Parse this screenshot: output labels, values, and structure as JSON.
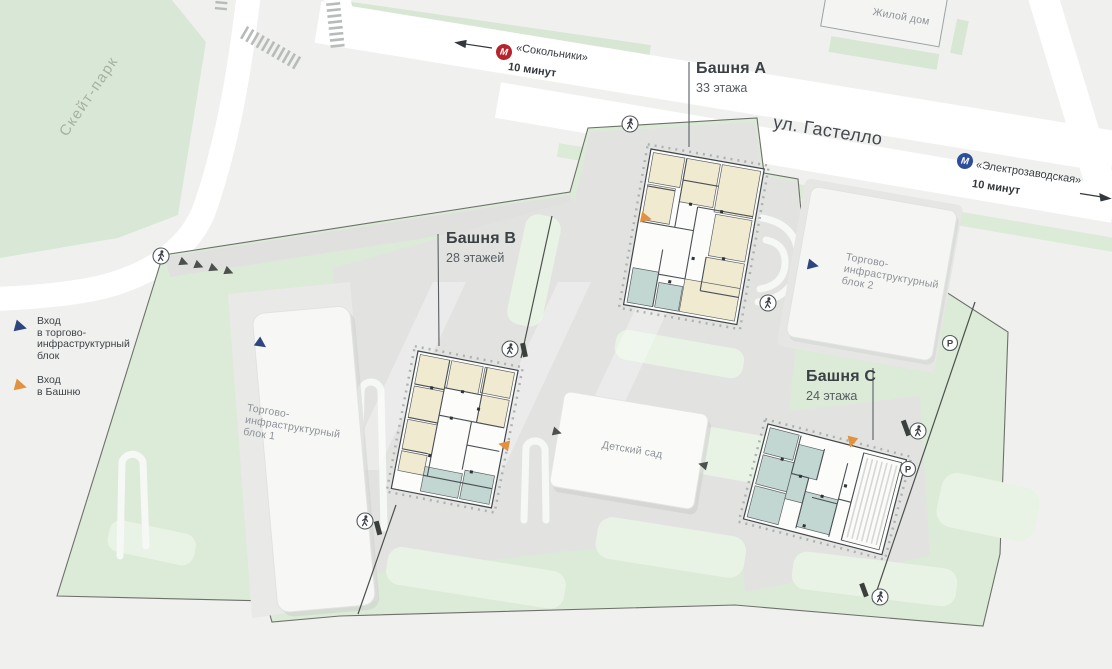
{
  "map": {
    "legend": {
      "items": [
        {
          "icon": "entrance-blue-triangle",
          "lines": [
            "Вход",
            "в торгово-",
            "инфраструктурный",
            "блок"
          ]
        },
        {
          "icon": "entrance-orange-triangle",
          "lines": [
            "Вход",
            "в Башню"
          ]
        }
      ]
    },
    "transit": {
      "metro_letter": "М",
      "stations": [
        {
          "id": "sokolniki",
          "name": "«Сокольники»",
          "time": "10 минут",
          "direction": "left"
        },
        {
          "id": "elektrozavodskaya",
          "name": "«Электрозаводская»",
          "time": "10 минут",
          "direction": "right"
        }
      ]
    },
    "street": {
      "gastello": "ул. Гастелло"
    },
    "places": {
      "skatepark": "Скейт-парк",
      "residential_house": "Жилой дом",
      "kindergarten": "Детский сад",
      "retail_block_1": {
        "lines": [
          "Торгово-",
          "инфраструктурный",
          "блок 1"
        ]
      },
      "retail_block_2": {
        "lines": [
          "Торгово-",
          "инфраструктурный",
          "блок 2"
        ]
      }
    },
    "towers": [
      {
        "id": "A",
        "name": "Башня A",
        "floors": "33 этажа"
      },
      {
        "id": "B",
        "name": "Башня B",
        "floors": "28 этажей"
      },
      {
        "id": "C",
        "name": "Башня C",
        "floors": "24 этажа"
      }
    ],
    "icons": {
      "parking_letter": "P",
      "pedestrian": "walking-person",
      "metro": "metro-m"
    },
    "colors": {
      "site_green": "#dcead8",
      "paving": "#e2e3e1",
      "lawn": "#e9f3e5",
      "navy": "#2e4680",
      "orange": "#e2913e",
      "metro_red": "#b5232b",
      "metro_blue": "#2c4d9b",
      "plan_cream": "#f0ead1",
      "plan_teal": "#c2d6d2"
    }
  }
}
